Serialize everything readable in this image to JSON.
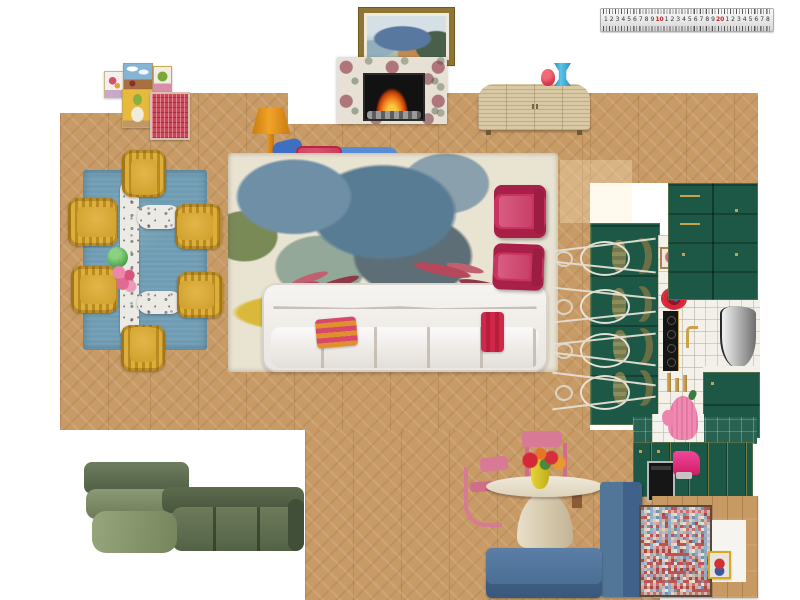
{
  "board": {
    "kind": "interior-design-moodboard-floorplan"
  },
  "ruler": {
    "numbers": [
      "1",
      "2",
      "3",
      "4",
      "5",
      "6",
      "7",
      "8",
      "9",
      "10",
      "1",
      "2",
      "3",
      "4",
      "5",
      "6",
      "7",
      "8",
      "9",
      "20",
      "1",
      "2",
      "3",
      "4",
      "5",
      "6",
      "7",
      "8"
    ],
    "highlight_numbers": [
      "10",
      "20"
    ],
    "number_color": "#333333",
    "highlight_color": "#cc2222"
  },
  "colors": {
    "wood_floor": "#c89b66",
    "kitchen_green": "#1d5847",
    "tile_green": "#2a6252",
    "dining_rug_blue": "#6f9cb2",
    "dining_chair_mustard": "#d2a335",
    "living_rug_cream": "#e9e3d2",
    "living_rug_yellow": "#d4b238",
    "sofa_white": "#f2f0ec",
    "armchair_magenta": "#c93360",
    "chaise_blue": "#4d82cf",
    "pillow_red": "#d5445f",
    "banquette_blue": "#4a6f96",
    "cabinet_blue": "#46688e",
    "nook_chair_pink": "#d87a95",
    "green_sofa_olive": "#5c6a4e",
    "lamp_orange": "#e8920c",
    "credenza_rattan": "#d8c8a4",
    "brass": "#c9a24a",
    "espresso_machine_pink": "#e8337a",
    "oven_mitt_pink": "#f08ab2",
    "cocotte_red": "#d42838"
  },
  "mosaic_palette": [
    "#9ab0c6",
    "#c05050",
    "#d8a090",
    "#b0c0d0",
    "#e0d0c0",
    "#a84848",
    "#7890a8",
    "#d0b8a8",
    "#c87070",
    "#90a8c0",
    "#e8e0d0",
    "#b85858"
  ],
  "items": [
    {
      "id": "ruler",
      "label": "metal ruler"
    },
    {
      "id": "landscape-painting",
      "label": "framed coastal landscape painting"
    },
    {
      "id": "gallery-wall",
      "label": "gallery wall of five small artworks"
    },
    {
      "id": "fireplace",
      "label": "marble fireplace with lit firebox"
    },
    {
      "id": "credenza",
      "label": "rattan credenza"
    },
    {
      "id": "red-vase",
      "label": "red vase"
    },
    {
      "id": "blue-vase",
      "label": "blue vase"
    },
    {
      "id": "dining-rug",
      "label": "blue rectangular rug"
    },
    {
      "id": "marble-table",
      "label": "marble dining table with benches"
    },
    {
      "id": "dining-chairs",
      "label": "six mustard velvet tub chairs"
    },
    {
      "id": "green-vase",
      "label": "green glass vase"
    },
    {
      "id": "pink-flowers",
      "label": "pink flower bouquet"
    },
    {
      "id": "floor-lamp",
      "label": "orange floor lamp"
    },
    {
      "id": "chaise",
      "label": "blue chaise longue"
    },
    {
      "id": "dog-pillow",
      "label": "red pillow with dachshund"
    },
    {
      "id": "striped-towel",
      "label": "red striped towel"
    },
    {
      "id": "living-rug",
      "label": "floral abstract area rug"
    },
    {
      "id": "white-sofa",
      "label": "white sectional sofa"
    },
    {
      "id": "striped-pillow",
      "label": "orange-pink striped pillow"
    },
    {
      "id": "red-pillow",
      "label": "red bolster pillow"
    },
    {
      "id": "pink-armchairs",
      "label": "two magenta armchairs"
    },
    {
      "id": "kitchen-island",
      "label": "dark green kitchen island"
    },
    {
      "id": "wire-stools",
      "label": "wire counter stools"
    },
    {
      "id": "olive-chairs",
      "label": "olive counter chairs"
    },
    {
      "id": "kitchen-cabinets",
      "label": "dark green cabinetry with brass hardware"
    },
    {
      "id": "range-hood",
      "label": "stainless range hood"
    },
    {
      "id": "cooktop",
      "label": "black gas cooktop"
    },
    {
      "id": "cocotte",
      "label": "red cocotte pot"
    },
    {
      "id": "food-board",
      "label": "framed food board"
    },
    {
      "id": "faucet",
      "label": "brass faucet"
    },
    {
      "id": "candlesticks",
      "label": "brass candlesticks"
    },
    {
      "id": "oven-mitt",
      "label": "pink oven mitt"
    },
    {
      "id": "wall-oven",
      "label": "built-in wall oven"
    },
    {
      "id": "espresso-machine",
      "label": "pink espresso machine"
    },
    {
      "id": "breakfast-table",
      "label": "round travertine pedestal table"
    },
    {
      "id": "nook-chairs",
      "label": "pink metal cantilever chairs"
    },
    {
      "id": "flower-vase",
      "label": "yellow vase with red flowers"
    },
    {
      "id": "banquette",
      "label": "blue velvet banquette"
    },
    {
      "id": "blue-cabinet",
      "label": "blue cabinet"
    },
    {
      "id": "green-sofa",
      "label": "olive green modular sofa"
    },
    {
      "id": "mosaic-rug",
      "label": "multicolor mosaic rug"
    },
    {
      "id": "wood-platform",
      "label": "oak platform frame"
    },
    {
      "id": "mini-artwork",
      "label": "small framed bird artwork"
    }
  ]
}
